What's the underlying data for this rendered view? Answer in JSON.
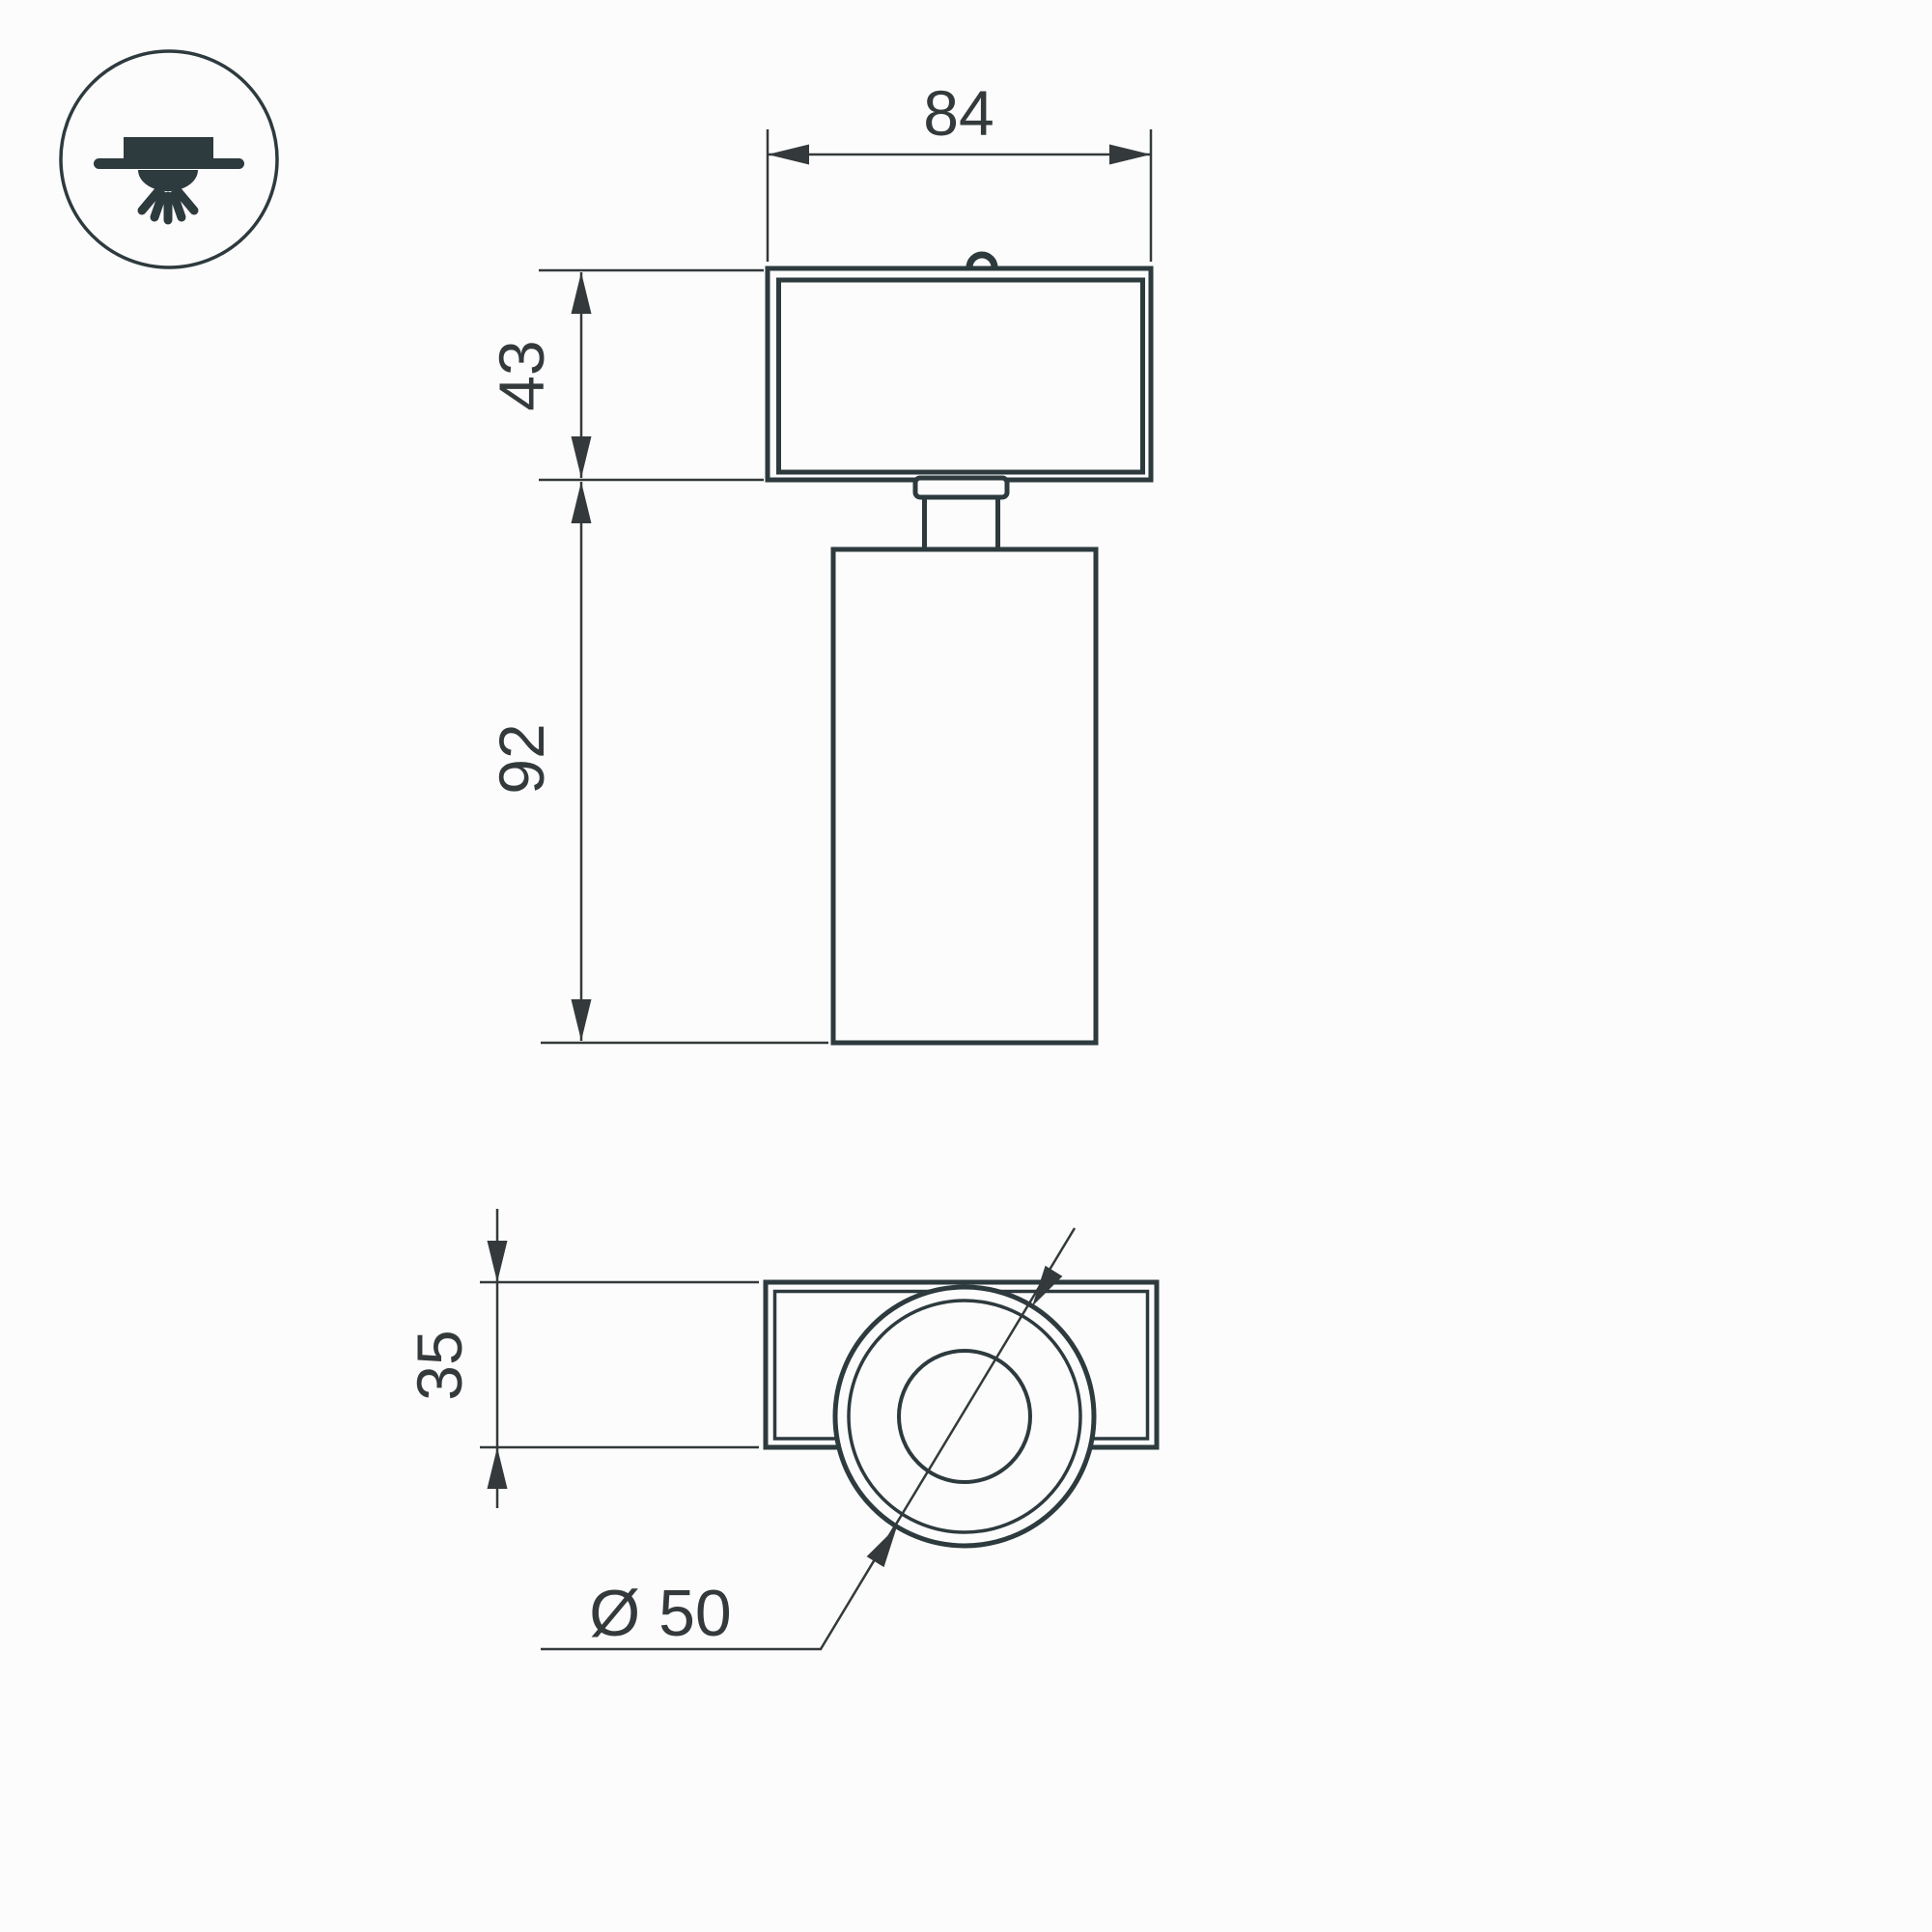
{
  "colors": {
    "outline": "#2d3a3e",
    "dimension": "#343a3b",
    "background": "#fcfcfc"
  },
  "icon": {
    "name": "surface-mounted-ceiling-light"
  },
  "front_view": {
    "width_label": "84",
    "base_height_label": "43",
    "body_height_label": "92"
  },
  "bottom_view": {
    "depth_label": "35",
    "diameter_label": "Ø 50"
  }
}
